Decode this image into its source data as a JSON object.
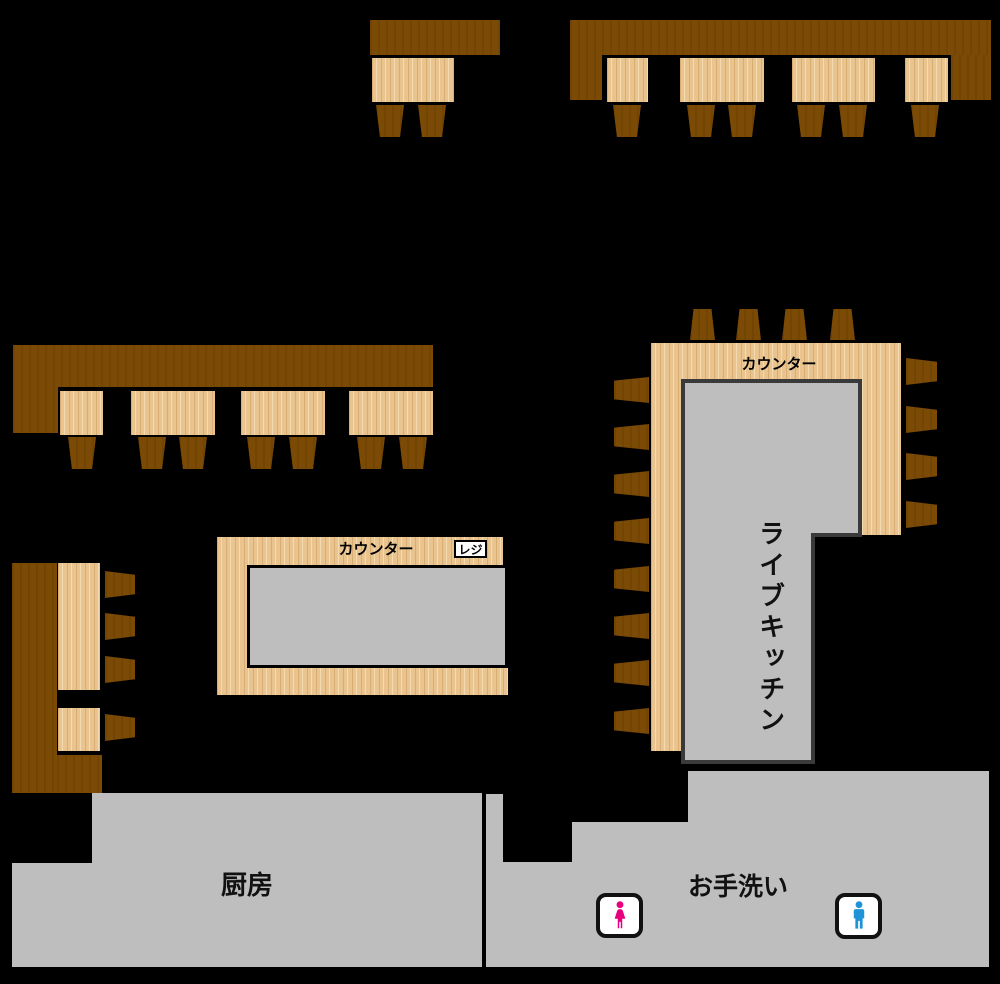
{
  "floorplan": {
    "labels": {
      "center_counter": "カウンター",
      "register": "レジ",
      "kitchen_counter": "カウンター",
      "live_kitchen": "ライブキッチン",
      "kitchen": "厨房",
      "restroom": "お手洗い"
    },
    "colors": {
      "background": "#000000",
      "bench_wood": "#7B4A04",
      "table_wood": "#EAC48E",
      "area_gray": "#BEBEBE",
      "female_icon_pink": "#E6007E",
      "male_icon_blue": "#1E93D7"
    },
    "icons": {
      "female": "female-restroom-icon",
      "male": "male-restroom-icon"
    }
  }
}
